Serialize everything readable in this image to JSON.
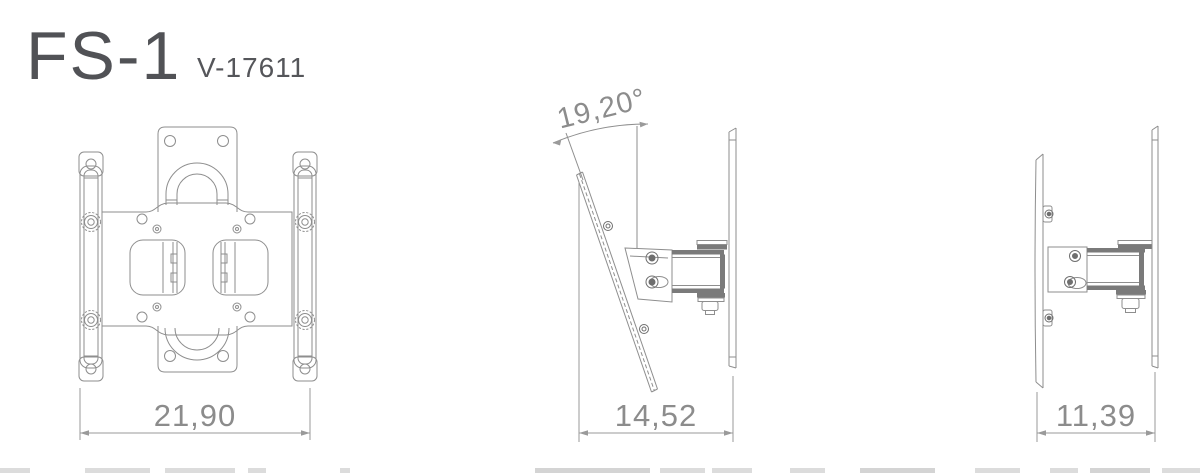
{
  "header": {
    "title": "FS-1",
    "model": "V-17611"
  },
  "views": {
    "front": {
      "dimension": "21,90"
    },
    "side_tilted": {
      "dimension": "14,52",
      "angle": "19,20°"
    },
    "side": {
      "dimension": "11,39"
    }
  },
  "colors": {
    "background": "#ffffff",
    "line": "#8e8e8e",
    "line_dark": "#6f6f6f",
    "dimension_line": "#9a9a9a",
    "dimension_text": "#8c8c8c",
    "title_text": "#515256"
  }
}
